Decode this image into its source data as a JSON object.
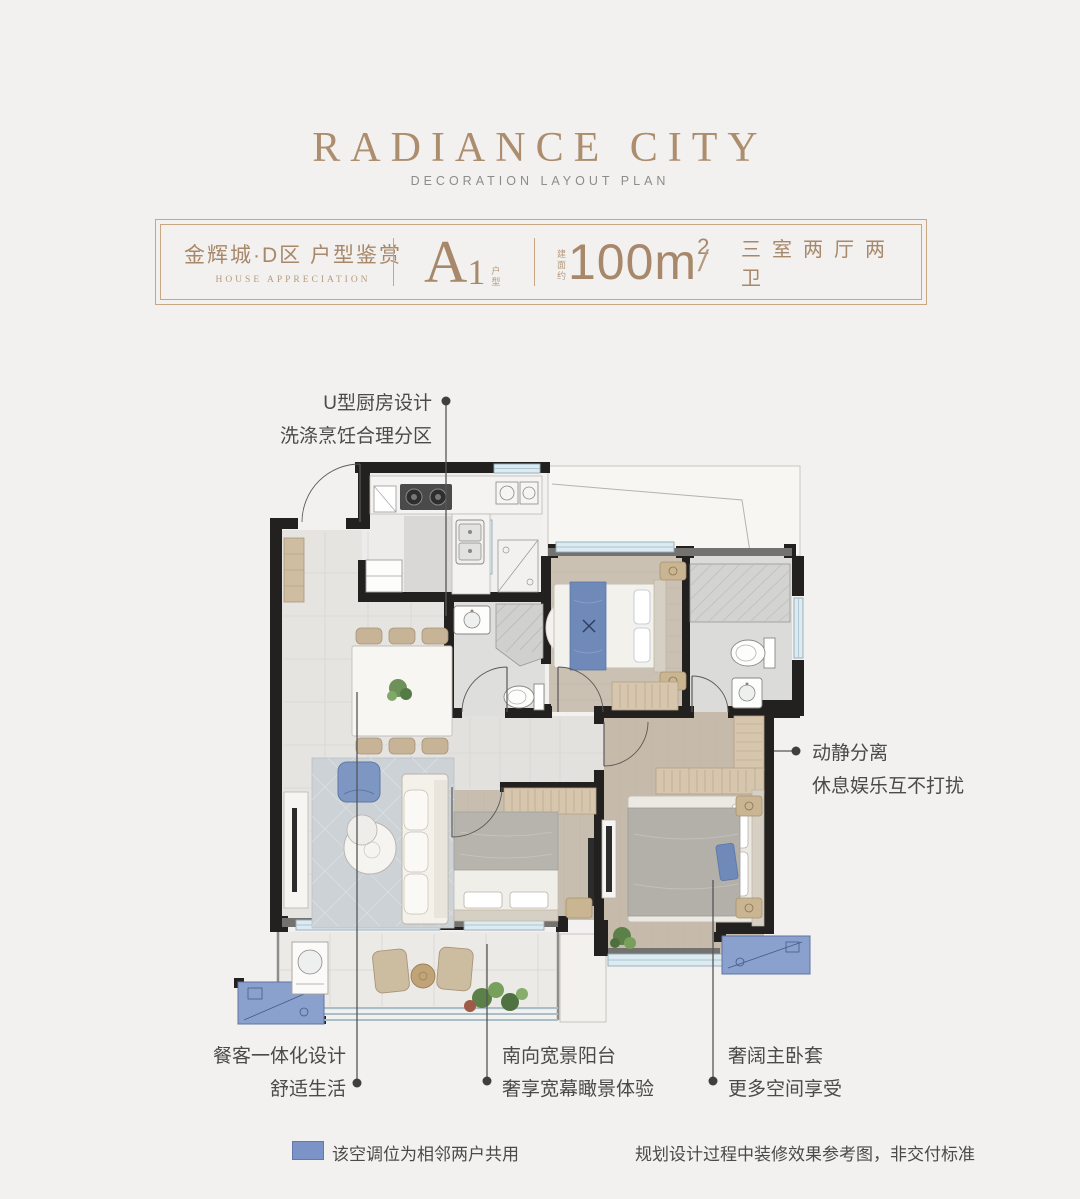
{
  "header": {
    "title": "RADIANCE CITY",
    "subtitle": "DECORATION LAYOUT PLAN"
  },
  "info_bar": {
    "project": "金辉城·D区 户型鉴赏",
    "project_en": "HOUSE APPRECIATION",
    "unit_letter": "A",
    "unit_number": "1",
    "unit_suffix": "户型",
    "area_prefix": "建面约",
    "area_value": "100m",
    "area_sup": "2",
    "separator": "/",
    "layout": "三室两厅两卫"
  },
  "annotations": {
    "kitchen": {
      "line1": "U型厨房设计",
      "line2": "洗涤烹饪合理分区"
    },
    "quiet": {
      "line1": "动静分离",
      "line2": "休息娱乐互不打扰"
    },
    "dining": {
      "line1": "餐客一体化设计",
      "line2": "舒适生活"
    },
    "balcony": {
      "line1": "南向宽景阳台",
      "line2": "奢享宽幕瞰景体验"
    },
    "master": {
      "line1": "奢阔主卧套",
      "line2": "更多空间享受"
    }
  },
  "legend": {
    "ac_note": "该空调位为相邻两户共用",
    "disclaimer": "规划设计过程中装修效果参考图，非交付标准",
    "swatch_color": "#7b93c6"
  },
  "colors": {
    "accent_gold": "#a8886a",
    "wall_black": "#23211f",
    "ac_blue": "#8ba1cd",
    "annotation_text": "#4a4a4a",
    "window_blue": "#dcebf2"
  }
}
